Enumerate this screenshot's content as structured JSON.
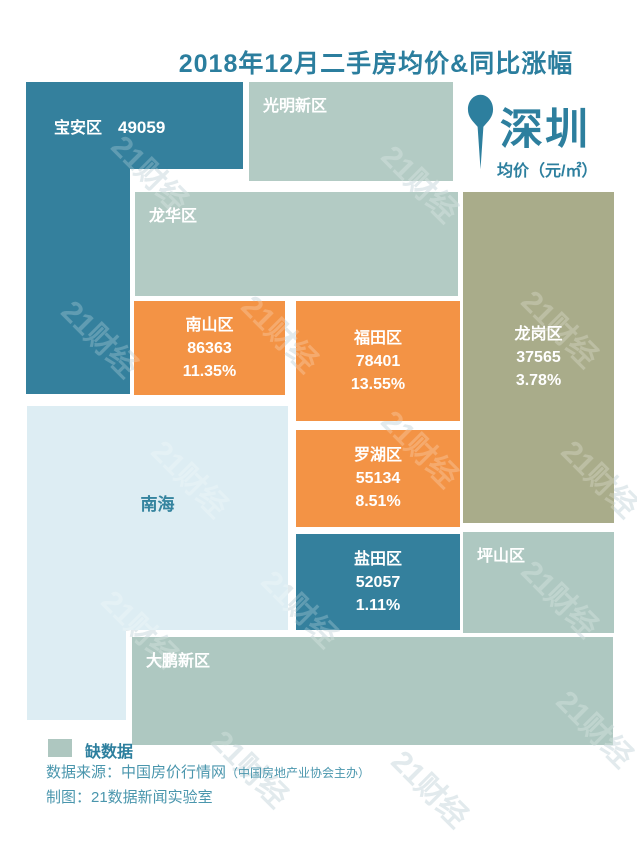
{
  "title": "2018年12月二手房均价&同比涨幅",
  "city_badge": {
    "name": "深圳",
    "unit_label": "均价（元/㎡）",
    "pin_icon": "location-pin-icon"
  },
  "districts": [
    {
      "name": "宝安区",
      "price": "49059",
      "change": "",
      "status": "price-only"
    },
    {
      "name": "光明新区",
      "price": "",
      "change": "",
      "status": "no-data"
    },
    {
      "name": "龙华区",
      "price": "",
      "change": "",
      "status": "no-data"
    },
    {
      "name": "南山区",
      "price": "86363",
      "change": "11.35%",
      "status": "price-and-change"
    },
    {
      "name": "福田区",
      "price": "78401",
      "change": "13.55%",
      "status": "price-and-change"
    },
    {
      "name": "龙岗区",
      "price": "37565",
      "change": "3.78%",
      "status": "price-and-change"
    },
    {
      "name": "南海",
      "price": "",
      "change": "",
      "status": "sea-area"
    },
    {
      "name": "罗湖区",
      "price": "55134",
      "change": "8.51%",
      "status": "price-and-change"
    },
    {
      "name": "盐田区",
      "price": "52057",
      "change": "1.11%",
      "status": "price-and-change"
    },
    {
      "name": "坪山区",
      "price": "",
      "change": "",
      "status": "no-data"
    },
    {
      "name": "大鹏新区",
      "price": "",
      "change": "",
      "status": "no-data"
    }
  ],
  "legend": {
    "label": "缺数据"
  },
  "source_line": {
    "prefix": "数据来源：中国房价行情网",
    "paren": "（中国房地产业协会主办）"
  },
  "credit_line": "制图：21数据新闻实验室",
  "watermark": "21财经",
  "colors": {
    "accent_teal_text": "#2d7f9e",
    "block_teal": "#34809d",
    "block_orange": "#f39345",
    "block_olive": "#a9ac8a",
    "block_no_data": "#b3cbc4",
    "block_sea": "#ddedf3",
    "source_text": "#4a96ad",
    "background": "#ffffff"
  },
  "chart_data": {
    "type": "heatmap",
    "title": "2018年12月二手房均价&同比涨幅",
    "city": "深圳",
    "unit": "元/㎡",
    "categories": [
      "宝安区",
      "光明新区",
      "龙华区",
      "南山区",
      "福田区",
      "龙岗区",
      "罗湖区",
      "盐田区",
      "坪山区",
      "大鹏新区",
      "南海"
    ],
    "series": [
      {
        "name": "均价(元/㎡)",
        "values": [
          49059,
          null,
          null,
          86363,
          78401,
          37565,
          55134,
          52057,
          null,
          null,
          null
        ]
      },
      {
        "name": "同比涨幅(%)",
        "values": [
          null,
          null,
          null,
          11.35,
          13.55,
          3.78,
          8.51,
          1.11,
          null,
          null,
          null
        ]
      }
    ],
    "legend": [
      "缺数据"
    ],
    "layout_hint": "区块按深圳各区地理方位排布的示意地图；灰绿色区块表示缺数据，橙色与蓝色区块标注均价与同比涨幅"
  }
}
